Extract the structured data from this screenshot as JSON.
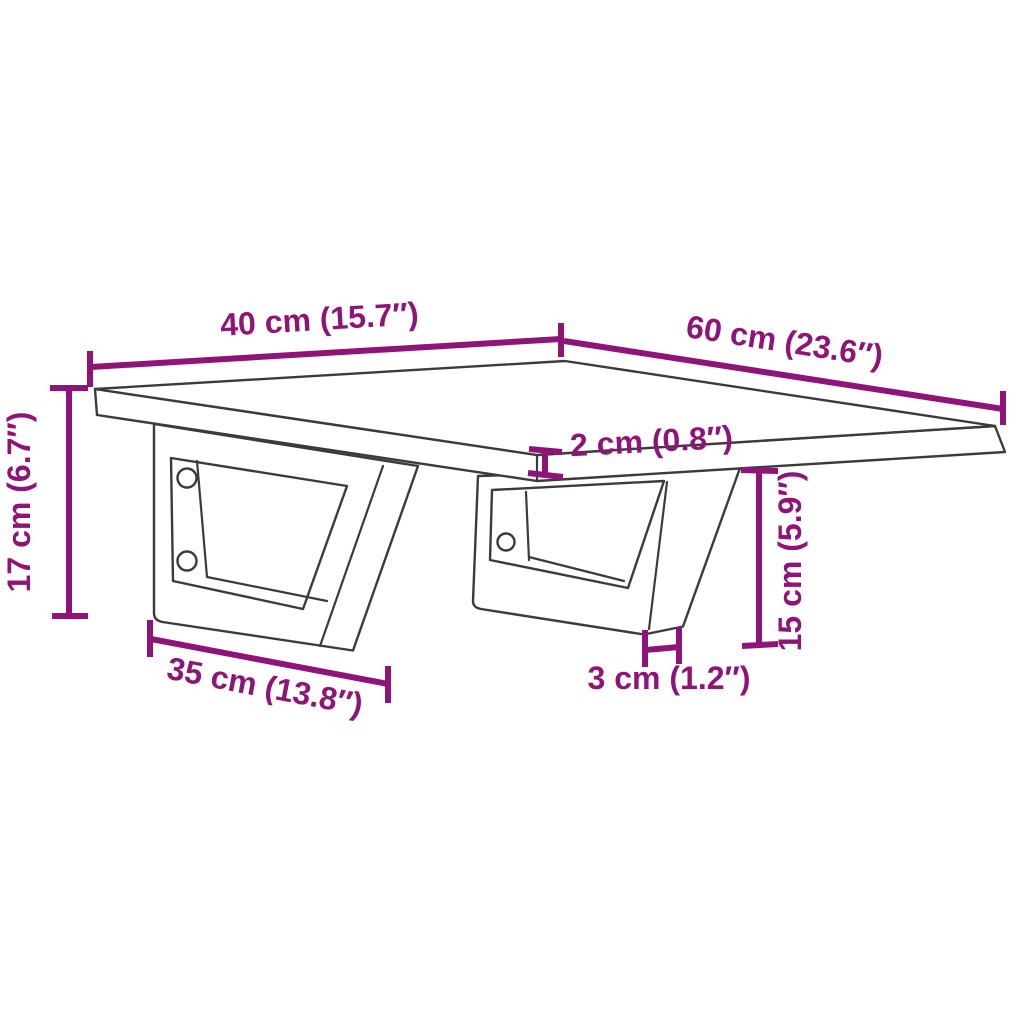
{
  "figure": {
    "kind": "product-dimension-diagram",
    "subject": "wall-mounted shelf with two trapezoid steel brackets",
    "background_color": "#ffffff",
    "drawing_line_color": "#3b3b3b",
    "dimension_color": "#8e1478",
    "dimensions": [
      {
        "id": "shelf-width",
        "label": "40 cm (15.7″)",
        "value_cm": 40,
        "value_in": 15.7
      },
      {
        "id": "shelf-depth",
        "label": "60 cm (23.6″)",
        "value_cm": 60,
        "value_in": 23.6
      },
      {
        "id": "bracket-height",
        "label": "17 cm (6.7″)",
        "value_cm": 17,
        "value_in": 6.7
      },
      {
        "id": "shelf-thickness",
        "label": "2 cm (0.8″)",
        "value_cm": 2,
        "value_in": 0.8
      },
      {
        "id": "leg-height",
        "label": "15 cm (5.9″)",
        "value_cm": 15,
        "value_in": 5.9
      },
      {
        "id": "bracket-bottom-width",
        "label": "35 cm (13.8″)",
        "value_cm": 35,
        "value_in": 13.8
      },
      {
        "id": "leg-width",
        "label": "3 cm (1.2″)",
        "value_cm": 3,
        "value_in": 1.2
      }
    ]
  }
}
